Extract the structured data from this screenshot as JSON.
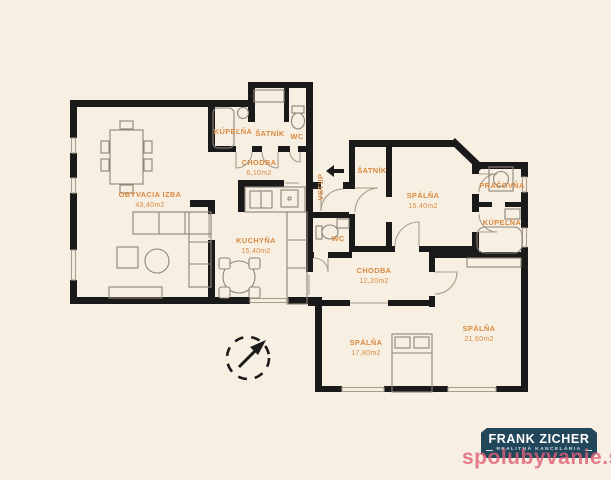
{
  "colors": {
    "background": "#F8EFE3",
    "wall": "#1A1A1A",
    "room_label": "#D8893F",
    "furniture_line": "#8D8579",
    "logo_bg": "#22465A",
    "watermark_pink": "#E05F78"
  },
  "rooms": [
    {
      "label": "OBÝVACIA IZBA",
      "area": "43,40m2"
    },
    {
      "label": "KÚPEĽŇA"
    },
    {
      "label": "ŠATNÍK"
    },
    {
      "label": "WC"
    },
    {
      "label": "CHODBA",
      "area": "6,10m2"
    },
    {
      "label": "KUCHYŇA",
      "area": "15,40m2"
    },
    {
      "label": "ŠATNÍK"
    },
    {
      "label": "SPÁLŇA",
      "area": "15,40m2"
    },
    {
      "label": "PRÁČOVŇA"
    },
    {
      "label": "KÚPEĽŇA"
    },
    {
      "label": "WC"
    },
    {
      "label": "CHODBA",
      "area": "12,20m2"
    },
    {
      "label": "SPÁLŇA",
      "area": "17,80m2"
    },
    {
      "label": "SPÁLŇA",
      "area": "21,60m2"
    }
  ],
  "entrance": {
    "label": "VSTUP"
  },
  "logo": {
    "title": "FRANK ZICHER",
    "subtitle": "REALITNÁ KANCELÁRIA"
  },
  "watermark": {
    "text": "spolubyvanie.sk"
  }
}
